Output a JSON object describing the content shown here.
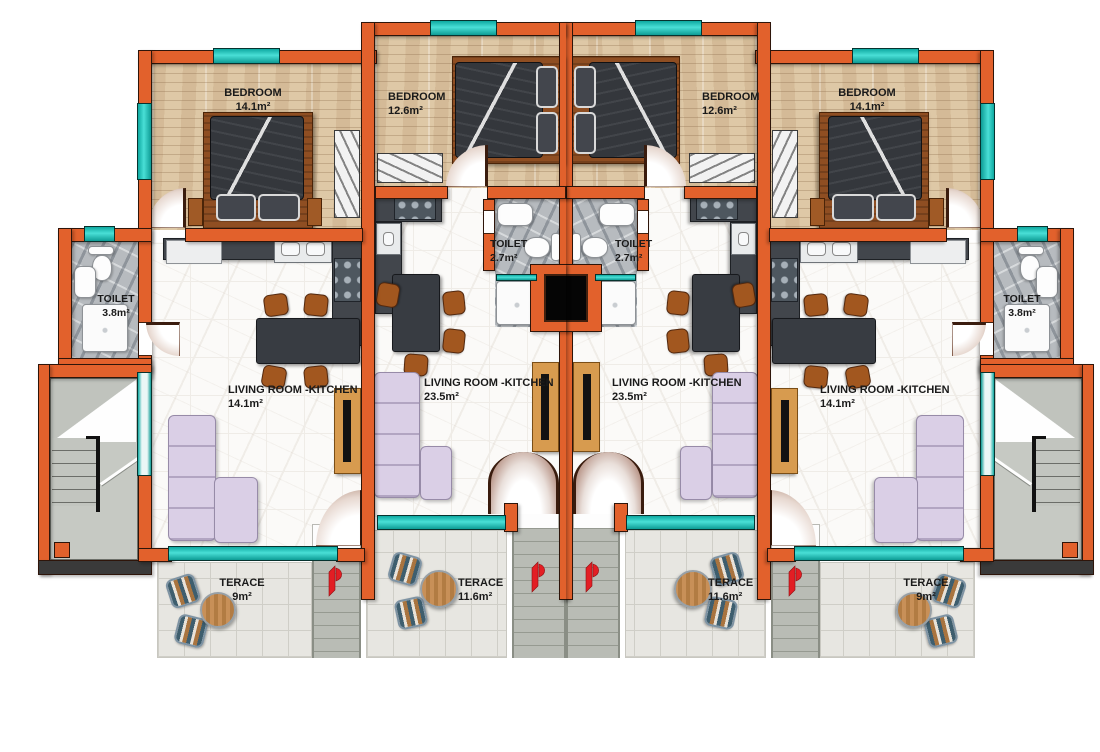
{
  "plan": {
    "type": "residential-floor-plan",
    "units": [
      {
        "id": "left-outer",
        "bedroom_label": "BEDROOM",
        "bedroom_area": "14.1m²",
        "toilet_label": "TOILET",
        "toilet_area": "3.8m²",
        "living_label": "LIVING ROOM -KITCHEN",
        "living_area": "14.1m²",
        "terrace_label": "TERACE",
        "terrace_area": "9m²"
      },
      {
        "id": "left-inner",
        "bedroom_label": "BEDROOM",
        "bedroom_area": "12.6m²",
        "toilet_label": "TOILET",
        "toilet_area": "2.7m²",
        "living_label": "LIVING ROOM -KITCHEN",
        "living_area": "23.5m²",
        "terrace_label": "TERACE",
        "terrace_area": "11.6m²"
      },
      {
        "id": "right-inner",
        "bedroom_label": "BEDROOM",
        "bedroom_area": "12.6m²",
        "toilet_label": "TOILET",
        "toilet_area": "2.7m²",
        "living_label": "LIVING ROOM -KITCHEN",
        "living_area": "23.5m²",
        "terrace_label": "TERACE",
        "terrace_area": "11.6m²"
      },
      {
        "id": "right-outer",
        "bedroom_label": "BEDROOM",
        "bedroom_area": "14.1m²",
        "toilet_label": "TOILET",
        "toilet_area": "3.8m²",
        "living_label": "LIVING ROOM -KITCHEN",
        "living_area": "14.1m²",
        "terrace_label": "TERACE",
        "terrace_area": "9m²"
      }
    ]
  },
  "colors": {
    "wall": "#E2612C",
    "window_teal": "#17BDB3",
    "floor_wood": "#DEC8A6",
    "floor_marble": "#FBFAF8",
    "bathroom_marble": "#B7BBBF",
    "terrace_tile": "#E7E6E1",
    "sofa_lavender": "#DACFE6",
    "kitchen_counter": "#42464C",
    "chair_wood": "#A2571F",
    "tv_unit_wood": "#D79B4F",
    "bed_duvet": "#34373C",
    "logo_red": "#E31E24",
    "stairs_grey": "#B9BCB5",
    "shaft_black": "#050505"
  }
}
